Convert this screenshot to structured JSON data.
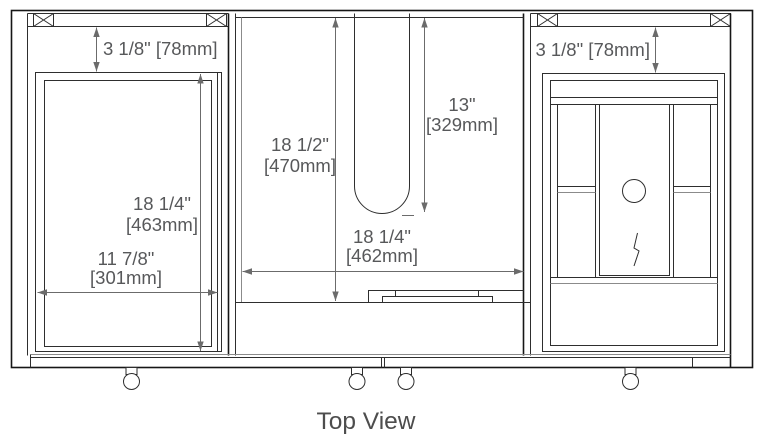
{
  "caption": "Top View",
  "colors": {
    "background": "#ffffff",
    "drawing_line": "#2e2e2e",
    "dimension_line": "#6b6b6b",
    "dimension_text": "#57585a",
    "caption_text": "#4d4d4d"
  },
  "dimensions": {
    "left_gap": {
      "label": "3 1/8\" [78mm]"
    },
    "right_gap": {
      "label": "3 1/8\" [78mm]"
    },
    "left_depth": {
      "inches": "18 1/4\"",
      "mm": "[463mm]"
    },
    "left_width": {
      "inches": "11 7/8\"",
      "mm": "[301mm]"
    },
    "middle_depth": {
      "inches": "18 1/2\"",
      "mm": "[470mm]"
    },
    "slot_depth": {
      "inches": "13\"",
      "mm": "[329mm]"
    },
    "middle_width": {
      "inches": "18 1/4\"",
      "mm": "[462mm]"
    }
  }
}
